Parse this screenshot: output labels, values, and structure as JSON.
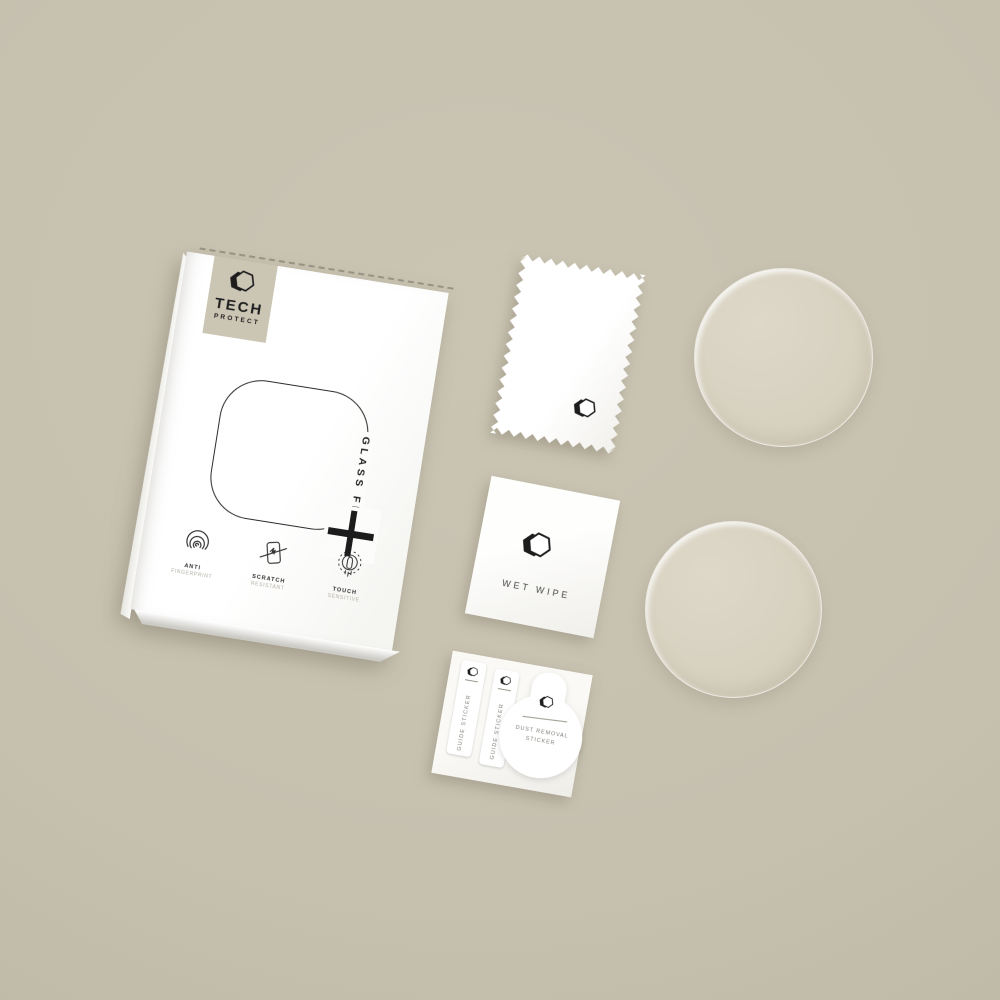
{
  "scene": {
    "description": "Flat-lay product photo of a Tech Protect Glass Fit watch screen protector kit: retail box, microfiber cloth, wet wipe, sticker sheet and two round glass protectors on a beige background"
  },
  "box": {
    "brand_line1": "TECH",
    "brand_line2": "PROTECT",
    "product_label": "GLASS FIT",
    "plus_symbol": "+",
    "features": [
      {
        "icon": "fingerprint-icon",
        "title": "ANTI",
        "subtitle": "FINGERPRINT"
      },
      {
        "icon": "scratch-resistant-icon",
        "title": "SCRATCH",
        "subtitle": "RESISTANT"
      },
      {
        "icon": "touch-sensitive-icon",
        "title": "TOUCH",
        "subtitle": "SENSITIVE"
      }
    ]
  },
  "accessories": {
    "wet_wipe": {
      "label": "WET WIPE"
    },
    "sticker_sheet": {
      "guide_sticker_1": "GUIDE STICKER",
      "guide_sticker_2": "GUIDE STICKER",
      "dust_removal_line1": "DUST REMOVAL",
      "dust_removal_line2": "STICKER"
    },
    "glass_discs": {
      "count": 2
    }
  },
  "colors": {
    "background": "#c6c0af",
    "box_front": "#ffffff",
    "brand_patch": "#cbc5b4",
    "ink": "#1f1f1f",
    "glass_disc": "#d9d3c3",
    "muted_text": "#84817a"
  }
}
